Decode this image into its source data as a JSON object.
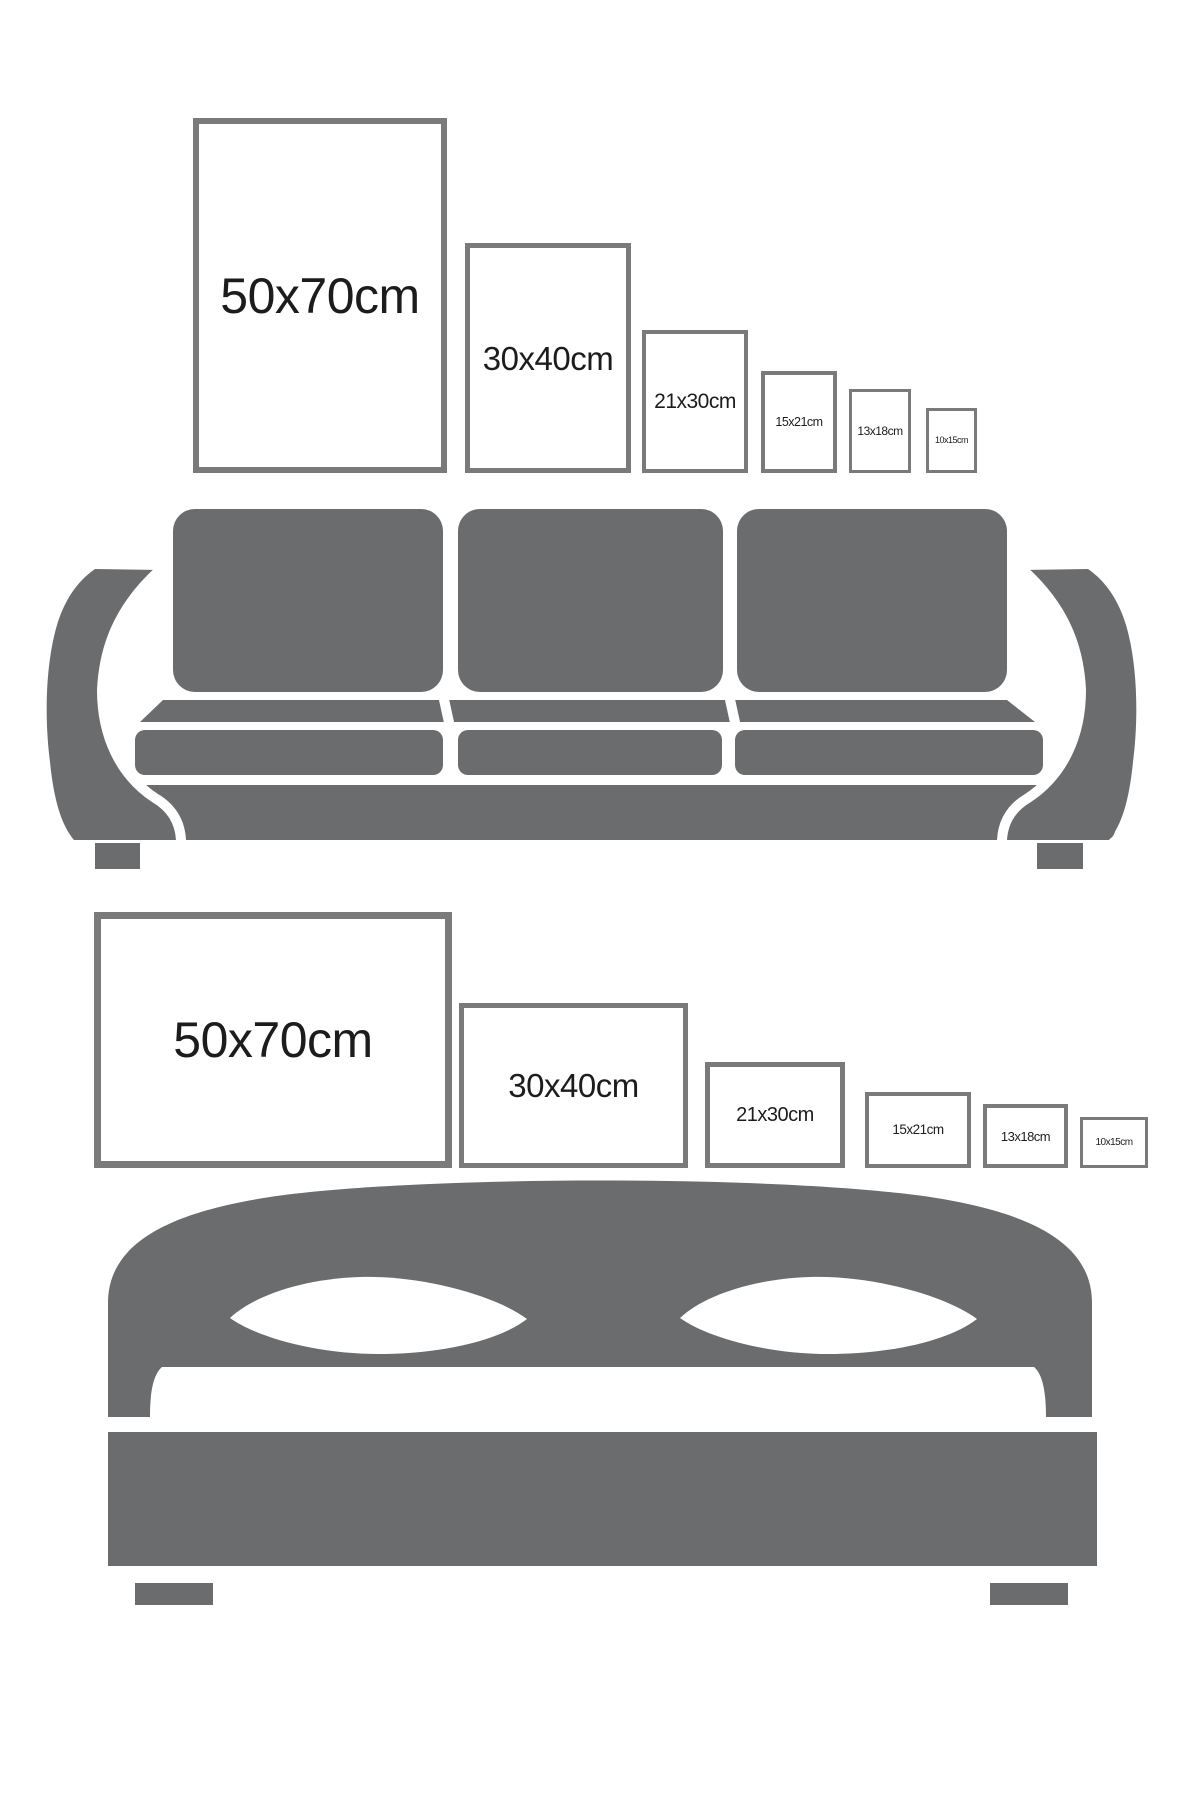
{
  "image_type": "poster-size-comparison-guide",
  "colors": {
    "background": "#ffffff",
    "furniture_gray": "#6a6c6d",
    "frame_border_gray": "#7a7a7a",
    "label_text": "#1c1c1c"
  },
  "sections": [
    {
      "id": "sofa-section",
      "furniture": "sofa",
      "frame_orientation": "portrait",
      "frames": [
        {
          "label": "50x70cm",
          "x": 193,
          "y": 118,
          "w": 254,
          "h": 355,
          "border": 6,
          "font": 50
        },
        {
          "label": "30x40cm",
          "x": 465,
          "y": 243,
          "w": 166,
          "h": 230,
          "border": 5,
          "font": 33
        },
        {
          "label": "21x30cm",
          "x": 642,
          "y": 330,
          "w": 106,
          "h": 143,
          "border": 4,
          "font": 21
        },
        {
          "label": "15x21cm",
          "x": 761,
          "y": 371,
          "w": 76,
          "h": 102,
          "border": 4,
          "font": 12.5
        },
        {
          "label": "13x18cm",
          "x": 849,
          "y": 389,
          "w": 62,
          "h": 84,
          "border": 3.5,
          "font": 12
        },
        {
          "label": "10x15cm",
          "x": 926,
          "y": 408,
          "w": 51,
          "h": 65,
          "border": 3,
          "font": 9
        }
      ]
    },
    {
      "id": "bed-section",
      "furniture": "bed",
      "frame_orientation": "landscape",
      "frames": [
        {
          "label": "50x70cm",
          "x": 94,
          "y": 912,
          "w": 358,
          "h": 256,
          "border": 7,
          "font": 50
        },
        {
          "label": "30x40cm",
          "x": 459,
          "y": 1003,
          "w": 229,
          "h": 165,
          "border": 5,
          "font": 33
        },
        {
          "label": "21x30cm",
          "x": 705,
          "y": 1062,
          "w": 140,
          "h": 106,
          "border": 5,
          "font": 20
        },
        {
          "label": "15x21cm",
          "x": 865,
          "y": 1092,
          "w": 106,
          "h": 76,
          "border": 4,
          "font": 13.5
        },
        {
          "label": "13x18cm",
          "x": 983,
          "y": 1104,
          "w": 85,
          "h": 64,
          "border": 4,
          "font": 13
        },
        {
          "label": "10x15cm",
          "x": 1080,
          "y": 1117,
          "w": 68,
          "h": 51,
          "border": 3,
          "font": 10
        }
      ]
    }
  ]
}
